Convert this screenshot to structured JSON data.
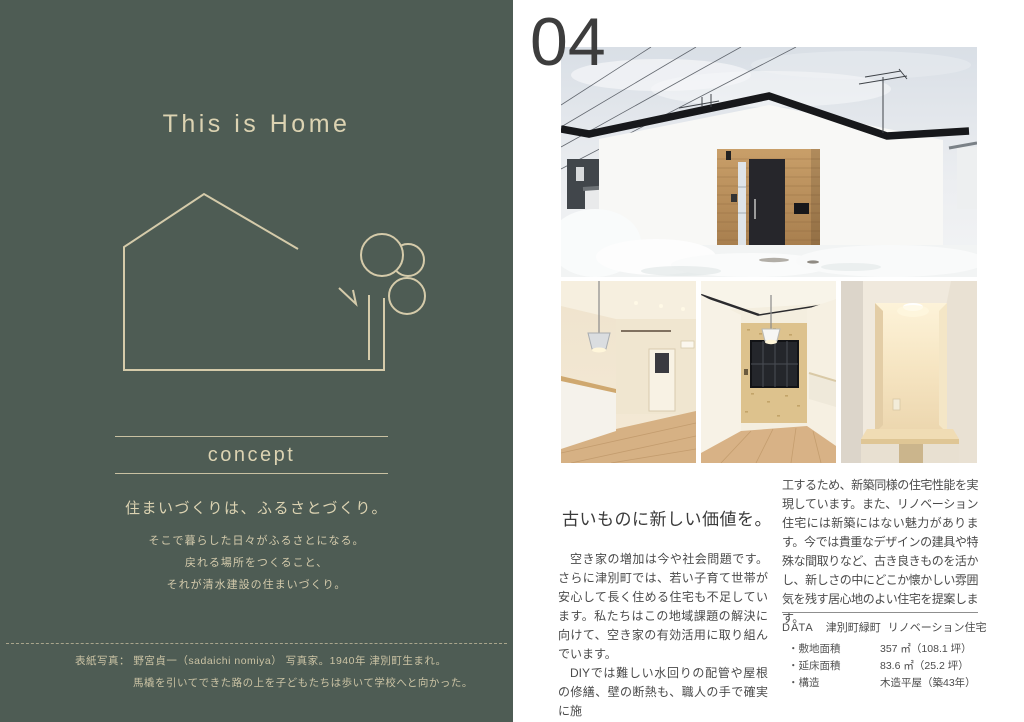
{
  "left_page": {
    "title": "This is Home",
    "concept_label": "concept",
    "tagline": "住まいづくりは、ふるさとづくり。",
    "concept_lines": [
      "そこで暮らした日々がふるさとになる。",
      "戻れる場所をつくること、",
      "それが清水建設の住まいづくり。"
    ],
    "caption_line1": "表紙写真： 野宮貞一（sadaichi nomiya） 写真家。1940年 津別町生まれ。",
    "caption_line2": "馬橇を引いてできた路の上を子どもたちは歩いて学校へと向かった。"
  },
  "right_page": {
    "page_number": "04",
    "heading": "古いものに新しい価値を。",
    "body_left_p1": "空き家の増加は今や社会問題です。さらに津別町では、若い子育て世帯が安心して長く住める住宅も不足しています。私たちはこの地域課題の解決に向けて、空き家の有効活用に取り組んでいます。",
    "body_left_p2": "DIYでは難しい水回りの配管や屋根の修繕、壁の断熱も、職人の手で確実に施",
    "body_right": "工するため、新築同様の住宅性能を実現しています。また、リノベーション住宅には新築にはない魅力があります。今では貴重なデザインの建具や特殊な間取りなど、古き良きものを活かし、新しさの中にどこか懐かしい雰囲気を残す居心地のよい住宅を提案します。",
    "data": {
      "label": "DATA",
      "location": "津別町緑町",
      "type": "リノベーション住宅",
      "rows": [
        {
          "label": "・敷地面積",
          "value": "357 ㎡（108.1 坪）"
        },
        {
          "label": "・延床面積",
          "value": "83.6 ㎡（25.2 坪）"
        },
        {
          "label": "・構造",
          "value": "木造平屋（築43年）"
        }
      ]
    }
  },
  "illustrations": {
    "house_tree": "house-and-tree-line-drawing",
    "photo_main": "renovated-house-exterior-in-snow",
    "photo_int1": "interior-living-kitchen-counter",
    "photo_int2": "interior-dining-osb-wall",
    "photo_int3": "interior-lit-alcove-desk"
  },
  "colors": {
    "left_page_background": "#4e5c54",
    "cream_text": "#dcd3b2",
    "roof_dark": "#17181b",
    "entrance_wood": "#c0955f",
    "body_text": "#4a4a4a",
    "page_number": "#3d3d3d"
  }
}
